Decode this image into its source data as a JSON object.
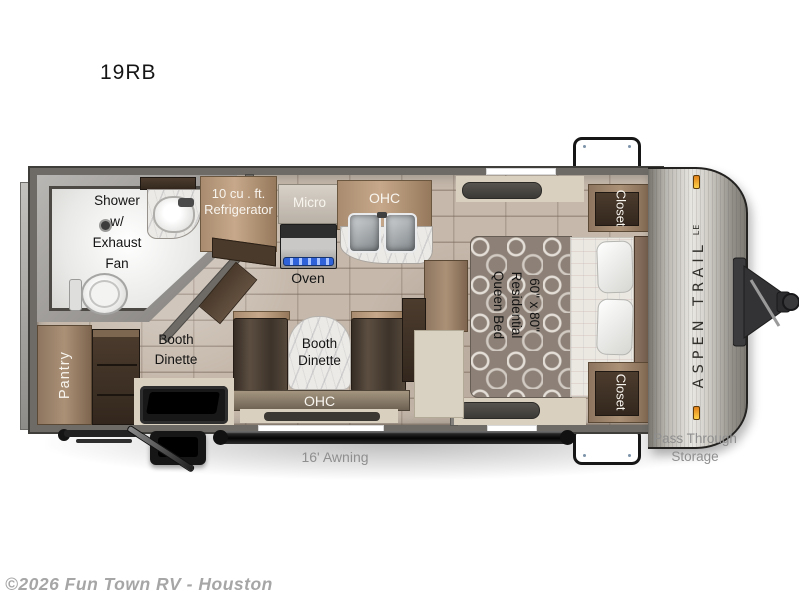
{
  "page": {
    "title": "19RB"
  },
  "footer": {
    "copyright": "©2026 Fun Town RV - Houston"
  },
  "brand": {
    "name": "ASPEN TRAIL",
    "series": "LE"
  },
  "exterior": {
    "awning": "16' Awning",
    "pass_through_line1": "Pass Through",
    "pass_through_line2": "Storage"
  },
  "bathroom": {
    "shower_line1": "Shower",
    "shower_line2": "w/",
    "shower_line3": "Exhaust",
    "shower_line4": "Fan"
  },
  "kitchen": {
    "fridge_line1": "10 cu . ft.",
    "fridge_line2": "Refrigerator",
    "micro": "Micro",
    "ohc": "OHC",
    "oven": "Oven"
  },
  "dinette": {
    "left_line1": "Booth",
    "left_line2": "Dinette",
    "center_line1": "Booth",
    "center_line2": "Dinette",
    "ohc": "OHC"
  },
  "storage": {
    "pantry": "Pantry",
    "closet_top": "Closet",
    "closet_bottom": "Closet"
  },
  "bedroom": {
    "bed_line1": "60\" x 80\"",
    "bed_line2": "Residential",
    "bed_line3": "Queen Bed"
  },
  "colors": {
    "floor_tile": "#c6b9ac",
    "wall": "#6e6b66",
    "wood": "#9a8168",
    "dark_wood": "#42352a",
    "marble": "#ece9e5",
    "label_gray": "#8f8f8f",
    "cap_silver": "#c7c4be",
    "marker_light": "#f39a1f",
    "oven_accent": "#3465d6",
    "awning_bar": "#1a1a1a"
  }
}
